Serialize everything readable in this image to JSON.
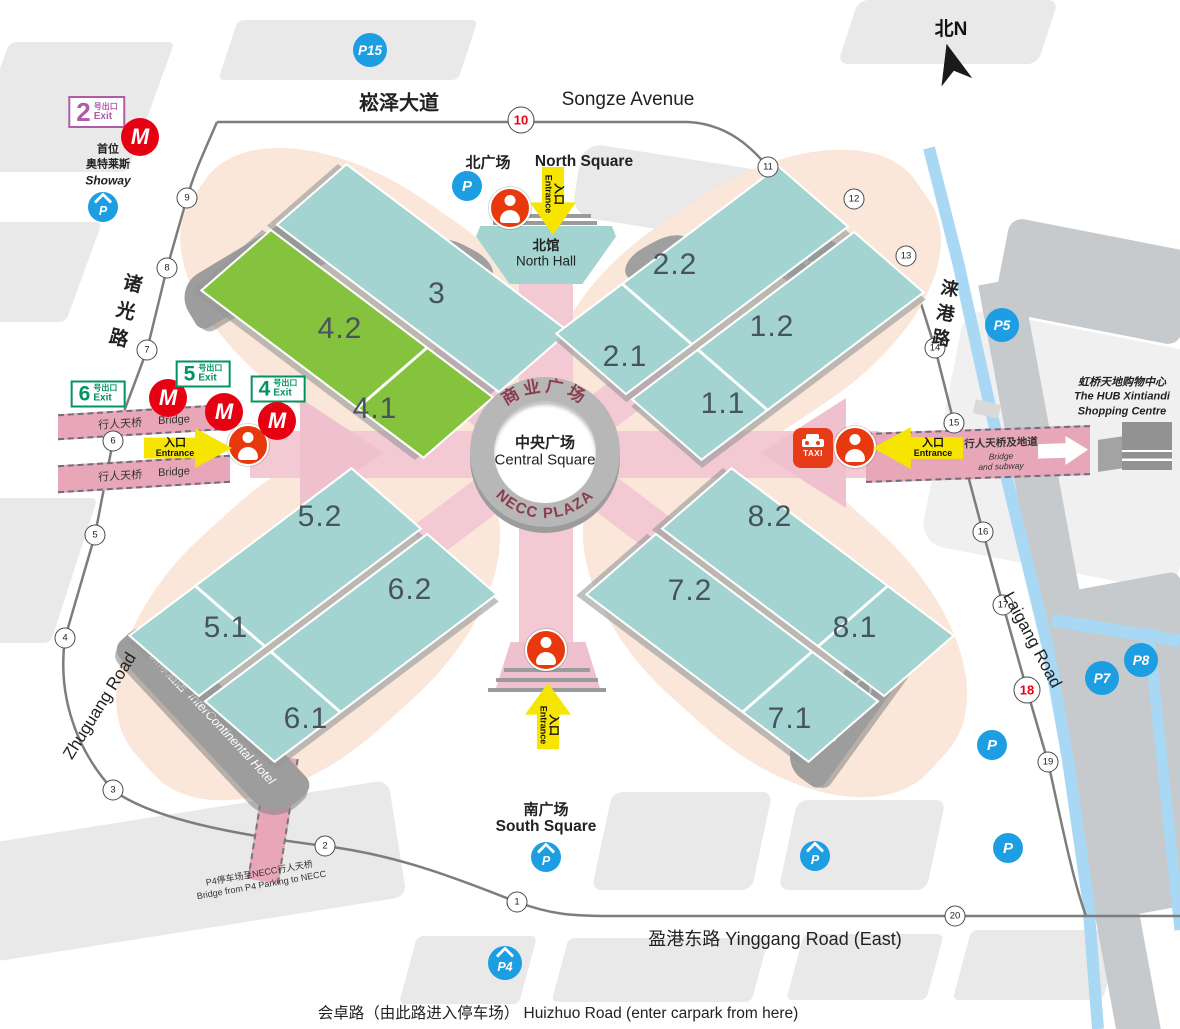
{
  "map": {
    "compass_label": "北N",
    "roads": {
      "songze_cn": "崧泽大道",
      "songze_en": "Songze Avenue",
      "zhuguang_cn": "诸光路",
      "zhuguang_en": "Zhuguang Road",
      "laigang_cn": "涞港路",
      "laigang_en": "Laigang Road",
      "yinggang": "盈港东路 Yinggang Road (East)",
      "huizhuo": "会卓路（由此路进入停车场）  Huizhuo Road (enter carpark from here)"
    },
    "squares": {
      "north_cn": "北广场",
      "north_en": "North Square",
      "south_cn": "南广场",
      "south_en": "South Square"
    },
    "north_hall": {
      "cn": "北馆",
      "en": "North Hall"
    },
    "plaza": {
      "ring_top": "商业广场",
      "center_cn": "中央广场",
      "center_en": "Central Square",
      "ring_bottom": "NECC PLAZA"
    },
    "buildings": {
      "office_a": {
        "cn": "办公楼",
        "en": "Office Bldg",
        "letter": "A"
      },
      "office_b": {
        "cn": "办公楼",
        "en": "Office Bldg",
        "letter": "B"
      },
      "office_c": {
        "cn": "办公楼",
        "en": "Office Bldg",
        "letter": "C"
      },
      "hotel": {
        "cn": "洲际酒店",
        "en": "InterContinental Hotel"
      },
      "hub": {
        "cn": "虹桥天地购物中心",
        "en1": "The HUB Xintiandi",
        "en2": "Shopping Centre"
      },
      "showay": {
        "cn1": "首位",
        "cn2": "奥特莱斯",
        "en": "Showay"
      },
      "taxi": "TAXI"
    },
    "bridges": {
      "west_cn": "行人天桥",
      "west_en": "Bridge",
      "east_cn": "行人天桥及地道",
      "east_en1": "Bridge",
      "east_en2": "and subway",
      "p4_cn": "P4停车场至NECC行人天桥",
      "p4_en": "Bridge from P4 Parking to NECC"
    },
    "halls": [
      {
        "label": "3",
        "x": 437,
        "y": 294
      },
      {
        "label": "4.2",
        "x": 340,
        "y": 329
      },
      {
        "label": "4.1",
        "x": 375,
        "y": 409
      },
      {
        "label": "2.2",
        "x": 675,
        "y": 265
      },
      {
        "label": "2.1",
        "x": 625,
        "y": 357
      },
      {
        "label": "1.2",
        "x": 772,
        "y": 327
      },
      {
        "label": "1.1",
        "x": 723,
        "y": 404
      },
      {
        "label": "5.2",
        "x": 320,
        "y": 517
      },
      {
        "label": "5.1",
        "x": 226,
        "y": 628
      },
      {
        "label": "6.2",
        "x": 410,
        "y": 590
      },
      {
        "label": "6.1",
        "x": 306,
        "y": 719
      },
      {
        "label": "8.2",
        "x": 770,
        "y": 517
      },
      {
        "label": "8.1",
        "x": 855,
        "y": 628
      },
      {
        "label": "7.2",
        "x": 690,
        "y": 591
      },
      {
        "label": "7.1",
        "x": 790,
        "y": 719
      }
    ],
    "gates": [
      {
        "n": "1",
        "x": 517,
        "y": 902
      },
      {
        "n": "2",
        "x": 325,
        "y": 846
      },
      {
        "n": "3",
        "x": 113,
        "y": 790
      },
      {
        "n": "4",
        "x": 65,
        "y": 638
      },
      {
        "n": "5",
        "x": 95,
        "y": 535
      },
      {
        "n": "6",
        "x": 113,
        "y": 441
      },
      {
        "n": "7",
        "x": 147,
        "y": 350
      },
      {
        "n": "8",
        "x": 167,
        "y": 268
      },
      {
        "n": "9",
        "x": 187,
        "y": 198
      },
      {
        "n": "10",
        "x": 521,
        "y": 120,
        "red": true
      },
      {
        "n": "11",
        "x": 768,
        "y": 167
      },
      {
        "n": "12",
        "x": 854,
        "y": 199
      },
      {
        "n": "13",
        "x": 906,
        "y": 256
      },
      {
        "n": "14",
        "x": 935,
        "y": 348
      },
      {
        "n": "15",
        "x": 954,
        "y": 423
      },
      {
        "n": "16",
        "x": 983,
        "y": 532
      },
      {
        "n": "17",
        "x": 1003,
        "y": 605
      },
      {
        "n": "18",
        "x": 1027,
        "y": 690,
        "red": true
      },
      {
        "n": "19",
        "x": 1048,
        "y": 762
      },
      {
        "n": "20",
        "x": 955,
        "y": 916
      }
    ],
    "parking": [
      {
        "label": "P15",
        "x": 370,
        "y": 50
      },
      {
        "label": "P",
        "x": 103,
        "y": 207,
        "roof": true
      },
      {
        "label": "P",
        "x": 467,
        "y": 186
      },
      {
        "label": "P5",
        "x": 1002,
        "y": 325
      },
      {
        "label": "P7",
        "x": 1102,
        "y": 678
      },
      {
        "label": "P8",
        "x": 1141,
        "y": 660
      },
      {
        "label": "P",
        "x": 992,
        "y": 745
      },
      {
        "label": "P",
        "x": 1008,
        "y": 848
      },
      {
        "label": "P",
        "x": 815,
        "y": 856,
        "roof": true
      },
      {
        "label": "P",
        "x": 546,
        "y": 857,
        "roof": true
      },
      {
        "label": "P4",
        "x": 505,
        "y": 963,
        "roof": true
      }
    ],
    "info_points": [
      {
        "x": 510,
        "y": 208
      },
      {
        "x": 248,
        "y": 445
      },
      {
        "x": 855,
        "y": 447
      },
      {
        "x": 546,
        "y": 650
      }
    ],
    "entrances": [
      {
        "dir": "down",
        "x": 553,
        "y": 201,
        "cn": "入口",
        "en": "Entrance"
      },
      {
        "dir": "right",
        "x": 188,
        "y": 448,
        "cn": "入口",
        "en": "Entrance"
      },
      {
        "dir": "left",
        "x": 918,
        "y": 448,
        "cn": "入口",
        "en": "Entrance"
      },
      {
        "dir": "up",
        "x": 548,
        "y": 716,
        "cn": "入口",
        "en": "Entrance"
      }
    ],
    "metro_exits": [
      {
        "num": "2",
        "suffix": "号出口",
        "exit": "Exit",
        "style": "purple",
        "x": 97,
        "y": 112,
        "lx": 140,
        "ly": 137
      },
      {
        "num": "6",
        "suffix": "号出口",
        "exit": "Exit",
        "style": "green",
        "x": 98,
        "y": 394,
        "lx": 168,
        "ly": 398
      },
      {
        "num": "5",
        "suffix": "号出口",
        "exit": "Exit",
        "style": "green",
        "x": 203,
        "y": 374,
        "lx": 224,
        "ly": 412
      },
      {
        "num": "4",
        "suffix": "号出口",
        "exit": "Exit",
        "style": "green",
        "x": 278,
        "y": 389,
        "lx": 277,
        "ly": 421
      }
    ],
    "colors": {
      "hall_teal": "#a3d4d1",
      "hall_green": "#85c23d",
      "walkway_pink": "#f3c9d4",
      "bridge_pink": "#e7a7b8",
      "peach_halo": "#fbe7d9",
      "metro_red": "#e60012",
      "parking_blue": "#1d9ee3",
      "exit_green": "#00945e",
      "exit_purple": "#b05ba8",
      "taxi_red": "#e63c17",
      "river_blue": "#a8d8f3",
      "road_gray": "#7d7d7d",
      "building_gray": "#9d9d9d"
    }
  }
}
